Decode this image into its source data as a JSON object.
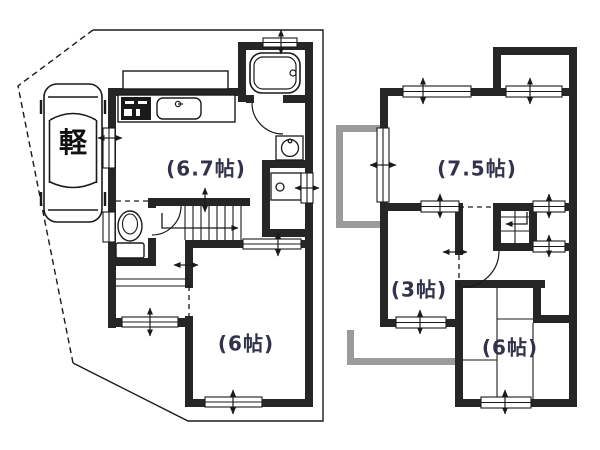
{
  "colors": {
    "background": "#ffffff",
    "wall": "#262626",
    "line": "#1a1a1a",
    "balcony": "#9b9b9b",
    "label_text": "#32324a"
  },
  "floor1": {
    "parking_label": "軽",
    "rooms": {
      "ldk": "(6.7帖)",
      "bedroom": "(6帖)"
    }
  },
  "floor2": {
    "rooms": {
      "bedroom_a": "(7.5帖)",
      "room_b": "(3帖)",
      "bedroom_c": "(6帖)"
    }
  }
}
